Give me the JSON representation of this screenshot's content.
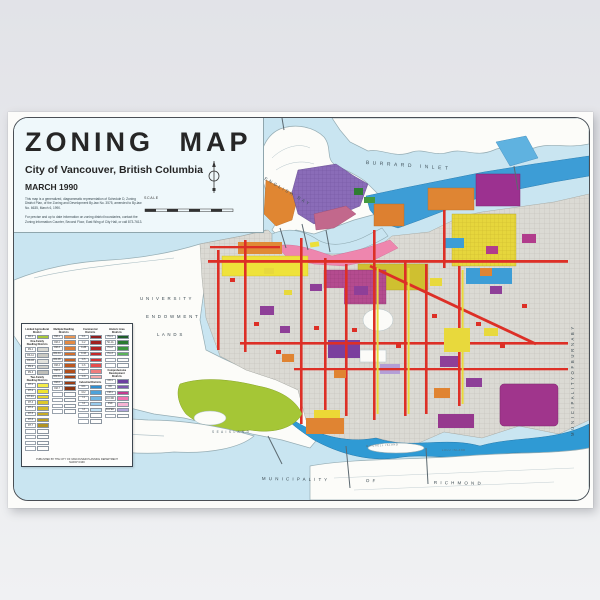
{
  "poster": {
    "title": "ZONING MAP",
    "subtitle": "City of Vancouver, British Columbia",
    "date": "MARCH 1990",
    "note1": "This map is a generalized, diagrammatic representation of Schedule D, Zoning District Plan, of the Zoning and Development By-law No. 3575, amended to By-law No. 6635, March 6, 1990.",
    "note2": "For precise and up to date information on zoning district boundaries, contact the Zoning Information Counter, Second Floor, East Wing of City Hall, or call 873-7613.",
    "scale_label": "SCALE"
  },
  "map_labels": [
    {
      "id": "burrard-inlet",
      "text": "BURRARD   INLET",
      "x": 352,
      "y": 42,
      "rot": 4,
      "size": 5,
      "ls": 3.5,
      "color": "#45565f"
    },
    {
      "id": "english-bay",
      "text": "ENGLISH  BAY",
      "x": 252,
      "y": 58,
      "rot": 30,
      "size": 4.4,
      "ls": 2.2,
      "color": "#45565f"
    },
    {
      "id": "uel-1",
      "text": "U N I V E R S I T Y",
      "x": 126,
      "y": 178,
      "rot": 0,
      "size": 4.4,
      "ls": 0.8,
      "color": "#3c4a52"
    },
    {
      "id": "uel-2",
      "text": "E N D O W M E N T",
      "x": 132,
      "y": 196,
      "rot": 0,
      "size": 4.4,
      "ls": 0.8,
      "color": "#3c4a52"
    },
    {
      "id": "uel-3",
      "text": "L A N D S",
      "x": 143,
      "y": 214,
      "rot": 0,
      "size": 4.4,
      "ls": 0.8,
      "color": "#3c4a52"
    },
    {
      "id": "sea-island",
      "text": "S E A     I S L A N D",
      "x": 198,
      "y": 312,
      "rot": 0,
      "size": 3.2,
      "ls": 0.8,
      "color": "#5a6b74"
    },
    {
      "id": "mitchell-island",
      "text": "MITCHELL  ISLAND",
      "x": 352,
      "y": 327,
      "rot": -3,
      "size": 2.5,
      "ls": 0.7,
      "color": "#5a6b74"
    },
    {
      "id": "lulu-island",
      "text": "LULU  ISLAND",
      "x": 428,
      "y": 331,
      "rot": 0,
      "size": 2.5,
      "ls": 0.7,
      "color": "#5a6b74"
    },
    {
      "id": "municipality",
      "text": "M U N I C I P A L I T Y",
      "x": 248,
      "y": 358,
      "rot": 1,
      "size": 4.4,
      "ls": 1,
      "color": "#3c4a52"
    },
    {
      "id": "of",
      "text": "O F",
      "x": 352,
      "y": 360,
      "rot": 2,
      "size": 4.4,
      "ls": 1,
      "color": "#3c4a52"
    },
    {
      "id": "richmond",
      "text": "R I C H M O N D",
      "x": 420,
      "y": 362,
      "rot": 1,
      "size": 4.4,
      "ls": 1,
      "color": "#3c4a52"
    },
    {
      "id": "municipality-of-burnaby",
      "text": "M U N I C I P A L I T Y     O F     B U R N A B Y",
      "x": 556,
      "y": 318,
      "rot": -90,
      "size": 4.2,
      "ls": 0.8,
      "color": "#3c4a52"
    }
  ],
  "legend": {
    "footer1": "PUBLISHED BY THE CITY OF VANCOUVER PLANNING DEPARTMENT",
    "footer2": "MARCH 1990",
    "columns": [
      {
        "sections": [
          {
            "header": "Limited Agricultural District",
            "items": [
              {
                "code": "RA-1",
                "color": "#a9c83b"
              }
            ]
          },
          {
            "header": "One-Family Dwelling Districts",
            "items": [
              {
                "code": "RS-1",
                "color": "#d8d8d2"
              },
              {
                "code": "RS-1A",
                "color": "#c9c9c3"
              },
              {
                "code": "RS-1B",
                "color": "#e2e2dc"
              },
              {
                "code": "RS-2",
                "color": "#cfcfc9"
              },
              {
                "code": "RS-3",
                "color": "#bfbfb9"
              }
            ]
          },
          {
            "header": "Two-Family Dwelling Districts",
            "items": [
              {
                "code": "RT-1",
                "color": "#f5ec49"
              },
              {
                "code": "RT-2",
                "color": "#f0e32f"
              },
              {
                "code": "RT-2A",
                "color": "#e6d52c"
              },
              {
                "code": "RT-3",
                "color": "#dcc72a"
              },
              {
                "code": "RT-4",
                "color": "#d2ba28"
              },
              {
                "code": "RT-5",
                "color": "#c8ad26"
              },
              {
                "code": "RT-6",
                "color": "#bda024"
              },
              {
                "code": "RT-7",
                "color": "#b29322"
              }
            ]
          },
          {
            "header": "",
            "items": [
              {
                "code": "",
                "color": ""
              },
              {
                "code": "",
                "color": ""
              },
              {
                "code": "",
                "color": ""
              },
              {
                "code": "",
                "color": ""
              }
            ]
          }
        ]
      },
      {
        "sections": [
          {
            "header": "Multiple Dwelling Districts",
            "items": [
              {
                "code": "RM-1",
                "color": "#e99755"
              },
              {
                "code": "RM-2",
                "color": "#e28a44"
              },
              {
                "code": "RM-3",
                "color": "#da7c36"
              },
              {
                "code": "RM-3A",
                "color": "#d16f2c"
              },
              {
                "code": "RM-3B",
                "color": "#c76325"
              },
              {
                "code": "RM-4",
                "color": "#bc5820"
              },
              {
                "code": "RM-5",
                "color": "#b04e1c"
              },
              {
                "code": "RM-5A",
                "color": "#a44518"
              },
              {
                "code": "RM-6",
                "color": "#983d15"
              },
              {
                "code": "RM-7",
                "color": "#8b3512"
              }
            ]
          },
          {
            "header": "",
            "items": [
              {
                "code": "",
                "color": ""
              },
              {
                "code": "",
                "color": ""
              },
              {
                "code": "",
                "color": ""
              },
              {
                "code": "",
                "color": ""
              }
            ]
          }
        ]
      },
      {
        "sections": [
          {
            "header": "Commercial Districts",
            "items": [
              {
                "code": "C-1",
                "color": "#8f1d1d"
              },
              {
                "code": "C-2",
                "color": "#a02020"
              },
              {
                "code": "C-2B",
                "color": "#b22424"
              },
              {
                "code": "C-3A",
                "color": "#c42a2a"
              },
              {
                "code": "C-5",
                "color": "#d63333"
              },
              {
                "code": "C-6",
                "color": "#e64d4d"
              },
              {
                "code": "C-7",
                "color": "#ef7d7d"
              },
              {
                "code": "C-8",
                "color": "#f5aaaa"
              }
            ]
          },
          {
            "header": "Industrial Districts",
            "items": [
              {
                "code": "M-1",
                "color": "#2e8ecf"
              },
              {
                "code": "M-2",
                "color": "#4da2da"
              },
              {
                "code": "I-1",
                "color": "#72b7e3"
              },
              {
                "code": "I-2",
                "color": "#99cdee"
              },
              {
                "code": "I-3",
                "color": "#c0e2f6"
              }
            ]
          },
          {
            "header": "",
            "items": [
              {
                "code": "",
                "color": ""
              },
              {
                "code": "",
                "color": ""
              }
            ]
          }
        ]
      },
      {
        "sections": [
          {
            "header": "Historic Area Districts",
            "items": [
              {
                "code": "HA-1",
                "color": "#1e5c28"
              },
              {
                "code": "HA-1A",
                "color": "#2b7a33"
              },
              {
                "code": "HA-2",
                "color": "#3d963f"
              },
              {
                "code": "HA-3",
                "color": "#5bb35a"
              }
            ]
          },
          {
            "header": "",
            "items": [
              {
                "code": "",
                "color": ""
              },
              {
                "code": "",
                "color": ""
              }
            ]
          },
          {
            "header": "Comprehensive Development Districts",
            "items": [
              {
                "code": "CD-1",
                "color": "#6d3f9f"
              },
              {
                "code": "DD",
                "color": "#7e57ae"
              },
              {
                "code": "FM-1",
                "color": "#c23a8e"
              },
              {
                "code": "FCCDD",
                "color": "#ef74b0"
              },
              {
                "code": "FSD",
                "color": "#f7b3d4"
              },
              {
                "code": "BCPED",
                "color": "#b3a6dc"
              }
            ]
          },
          {
            "header": "",
            "items": [
              {
                "code": "",
                "color": ""
              }
            ]
          }
        ]
      }
    ]
  },
  "palette": {
    "water": "#c9e5f1",
    "land": "#fcfcf9",
    "residential_gray": "#dbdad4",
    "two_family_yellow": "#eee23a",
    "multiple_orange": "#e08632",
    "commercial_red": "#dd2f26",
    "industrial_blue": "#3d9dd6",
    "agricultural_green": "#a5c636",
    "historic_green": "#2e7d32",
    "comprehensive_purple": "#8e3f98",
    "downtown_violet": "#8a6cb8",
    "false_creek_pink": "#ee86ae",
    "cd_magenta": "#a0358c"
  }
}
